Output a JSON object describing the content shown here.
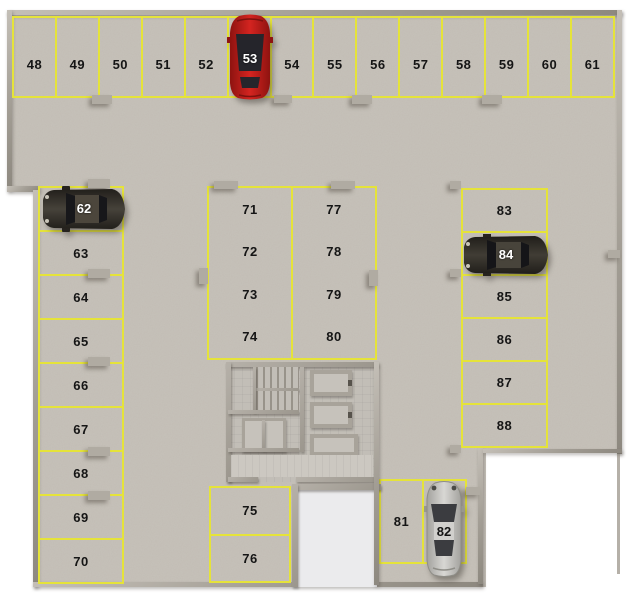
{
  "scene": {
    "title": "Parking level plan, spaces 48-88",
    "total_spaces": 41
  },
  "spaces": {
    "top_row": [
      "48",
      "49",
      "50",
      "51",
      "52",
      "53",
      "54",
      "55",
      "56",
      "57",
      "58",
      "59",
      "60",
      "61"
    ],
    "left_column": [
      "62",
      "63",
      "64",
      "65",
      "66",
      "67",
      "68",
      "69",
      "70"
    ],
    "mid_left_column": [
      "71",
      "72",
      "73",
      "74"
    ],
    "mid_right_column": [
      "77",
      "78",
      "79",
      "80"
    ],
    "bottom_mid_column": [
      "75",
      "76"
    ],
    "right_column": [
      "83",
      "84",
      "85",
      "86",
      "87",
      "88"
    ],
    "bottom_right_row": [
      "81",
      "82"
    ]
  },
  "cars": [
    {
      "space_label": "53",
      "body_color": "#c2201a",
      "label_color": "#ffffff",
      "orientation": "vertical",
      "location": "top row"
    },
    {
      "space_label": "62",
      "body_color": "#3a362f",
      "label_color": "#ffffff",
      "orientation": "horizontal",
      "location": "left column"
    },
    {
      "space_label": "84",
      "body_color": "#37342e",
      "label_color": "#ffffff",
      "orientation": "horizontal",
      "location": "right column"
    },
    {
      "space_label": "82",
      "body_color": "#cccbc8",
      "label_color": "#141414",
      "orientation": "vertical",
      "location": "bottom right"
    }
  ],
  "colors": {
    "floor_concrete": "#c7c2ba",
    "marking_yellow": "#e5e33a",
    "wall_gray": "#a8a39a",
    "ramp_floor": "#ebebed",
    "number_black": "#151515",
    "background_white": "#ffffff"
  }
}
